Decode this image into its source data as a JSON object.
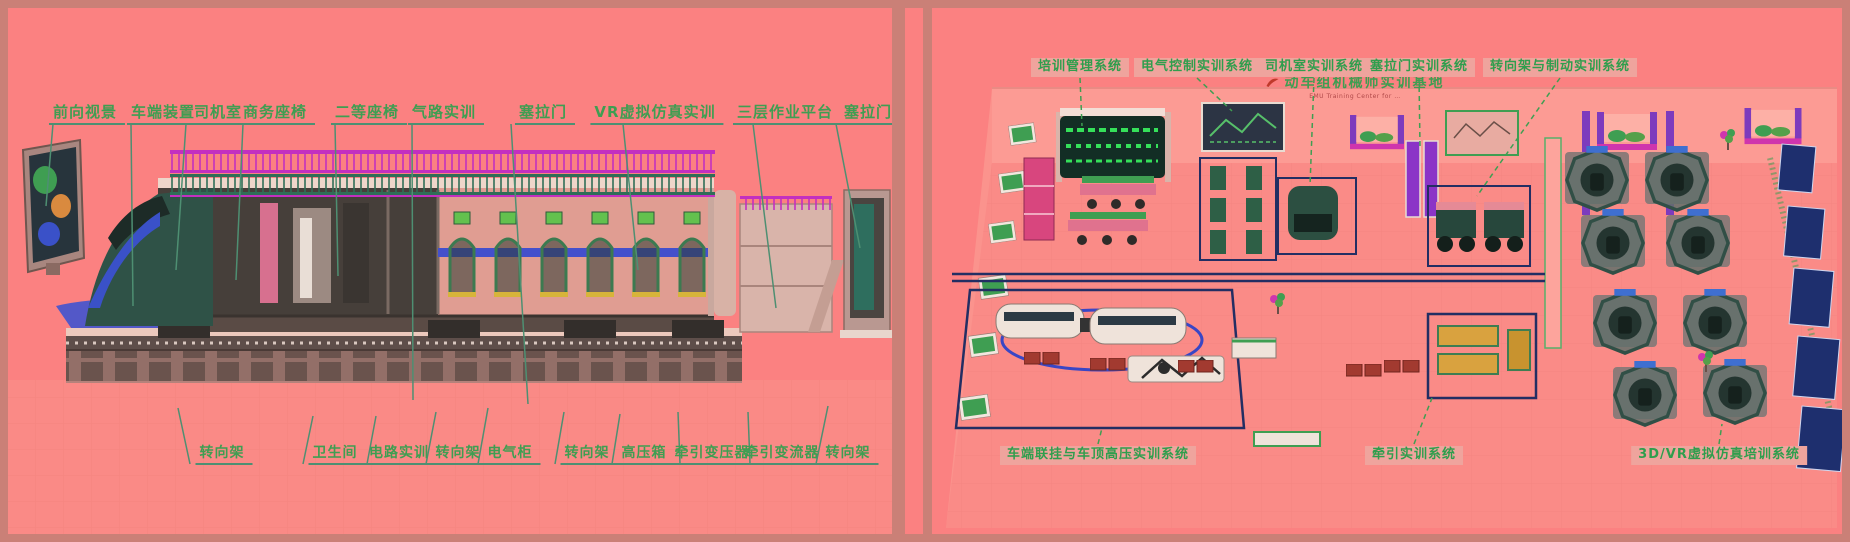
{
  "colors": {
    "canvas_border": "#ca8077",
    "panel_bg": "#fb8181",
    "label_green": "#3f9e52",
    "leader_teal": "#4e8f72",
    "chip_bg": "#efa49d",
    "scaffold_magenta": "#c32fc0",
    "zone_navy": "#232e63",
    "floor_path_blue": "#4053cf"
  },
  "left_panel": {
    "labels_top": [
      "前向视景",
      "车端装置",
      "司机室",
      "商务座椅",
      "二等座椅",
      "气路实训",
      "塞拉门",
      "VR虚拟仿真实训",
      "三层作业平台",
      "塞拉门"
    ],
    "labels_bottom": [
      "转向架",
      "卫生间",
      "电路实训",
      "转向架",
      "电气柜",
      "转向架",
      "高压箱",
      "牵引变压器",
      "牵引变流器",
      "转向架"
    ]
  },
  "right_panel": {
    "labels_top": [
      "培训管理系统",
      "电气控制实训系统",
      "司机室实训系统",
      "塞拉门实训系统",
      "转向架与制动实训系统"
    ],
    "banner": {
      "title": "动车组机械师实训基地",
      "subtitle": "EMU Training Center for …"
    },
    "labels_bottom": [
      "车端联挂与车顶高压实训系统",
      "牵引实训系统",
      "3D/VR虚拟仿真培训系统"
    ]
  }
}
